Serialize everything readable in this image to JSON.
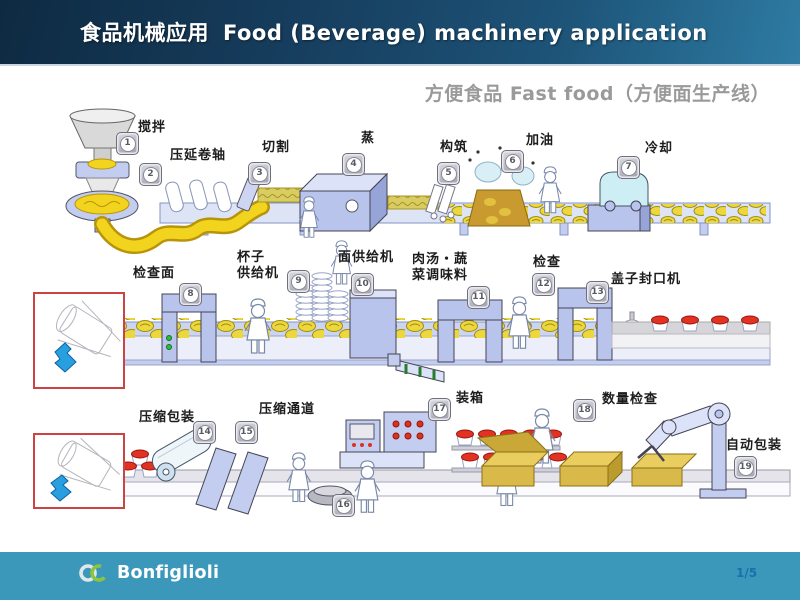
{
  "header": {
    "title_zh": "食品机械应用",
    "title_en": "Food (Beverage) machinery application"
  },
  "subtitle": "方便食品 Fast food（方便面生产线）",
  "stations": [
    {
      "num": "1",
      "label": "搅拌"
    },
    {
      "num": "2",
      "label": "压延卷轴"
    },
    {
      "num": "3",
      "label": "切割"
    },
    {
      "num": "4",
      "label": "蒸"
    },
    {
      "num": "5",
      "label": "构筑"
    },
    {
      "num": "6",
      "label": "加油"
    },
    {
      "num": "7",
      "label": "冷却"
    },
    {
      "num": "8",
      "label": "检查面"
    },
    {
      "num": "9",
      "label": "杯子\n供给机"
    },
    {
      "num": "10",
      "label": "面供给机"
    },
    {
      "num": "11",
      "label": "肉汤・蔬\n菜调味料"
    },
    {
      "num": "12",
      "label": "检查"
    },
    {
      "num": "13",
      "label": "盖子封口机"
    },
    {
      "num": "14",
      "label": "压缩包装"
    },
    {
      "num": "15",
      "label": "压缩通道"
    },
    {
      "num": "16",
      "label": ""
    },
    {
      "num": "17",
      "label": "装箱"
    },
    {
      "num": "18",
      "label": "数量检查"
    },
    {
      "num": "19",
      "label": "自动包装"
    }
  ],
  "footer": {
    "brand": "Bonfiglioli",
    "page": "1/5"
  },
  "colors": {
    "header_dark": "#0e2a42",
    "header_light": "#2e7ba3",
    "footer_bar": "#3b98bb",
    "inset_border": "#cc4343",
    "page_number": "#1b6fad",
    "machine_blue": "#b9c4ec",
    "dough_yellow": "#f2d41e",
    "lid_red": "#e23322",
    "box_tan": "#d9b94a"
  }
}
